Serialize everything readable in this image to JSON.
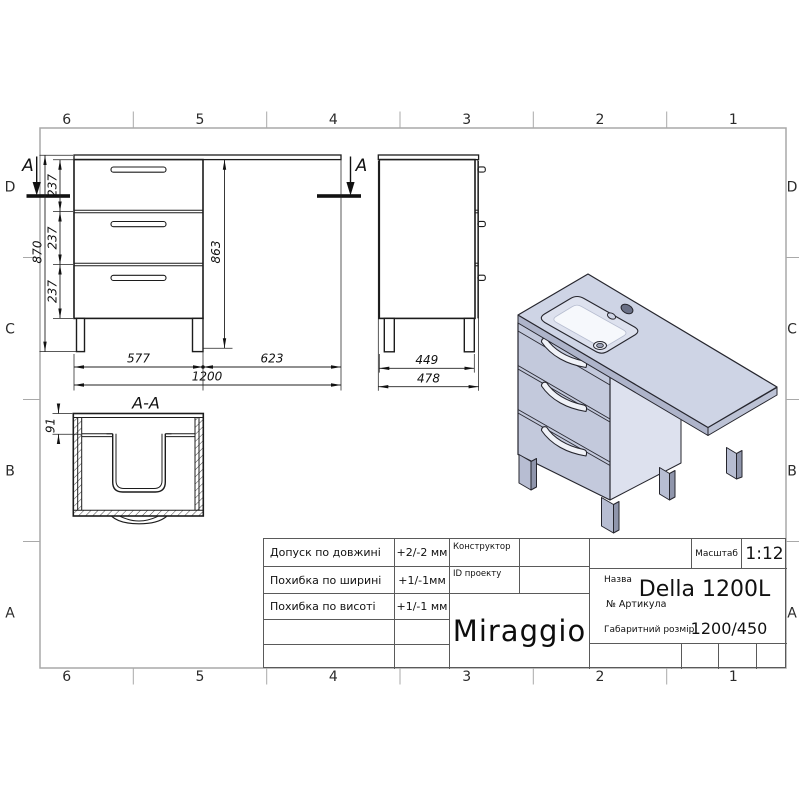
{
  "sheet": {
    "cols": [
      "6",
      "5",
      "4",
      "3",
      "2",
      "1"
    ],
    "rows": [
      "D",
      "C",
      "B",
      "A"
    ]
  },
  "front_view": {
    "section_label_left": "A",
    "section_label_right": "A",
    "dim_870": "870",
    "dim_863": "863",
    "dim_237_top": "237",
    "dim_237_mid": "237",
    "dim_237_bot": "237",
    "dim_577": "577",
    "dim_623": "623",
    "dim_1200": "1200"
  },
  "side_view": {
    "dim_449": "449",
    "dim_478": "478"
  },
  "section_view": {
    "title": "A-A",
    "dim_91": "91"
  },
  "title_block": {
    "tolerances": [
      {
        "label": "Допуск по довжині",
        "value": "+2/-2 мм"
      },
      {
        "label": "Похибка по ширині",
        "value": "+1/-1мм"
      },
      {
        "label": "Похибка по висоті",
        "value": "+1/-1 мм"
      }
    ],
    "constructor_label": "Конструктор",
    "project_id_label": "ID проекту",
    "brand": "Miraggio",
    "scale_label": "Масштаб",
    "scale_value": "1:12",
    "name_label": "Назва",
    "name_value": "Della 1200L",
    "article_label": "№  Артикула",
    "overall_label": "Габаритний розмір",
    "overall_value": "1200/450"
  }
}
